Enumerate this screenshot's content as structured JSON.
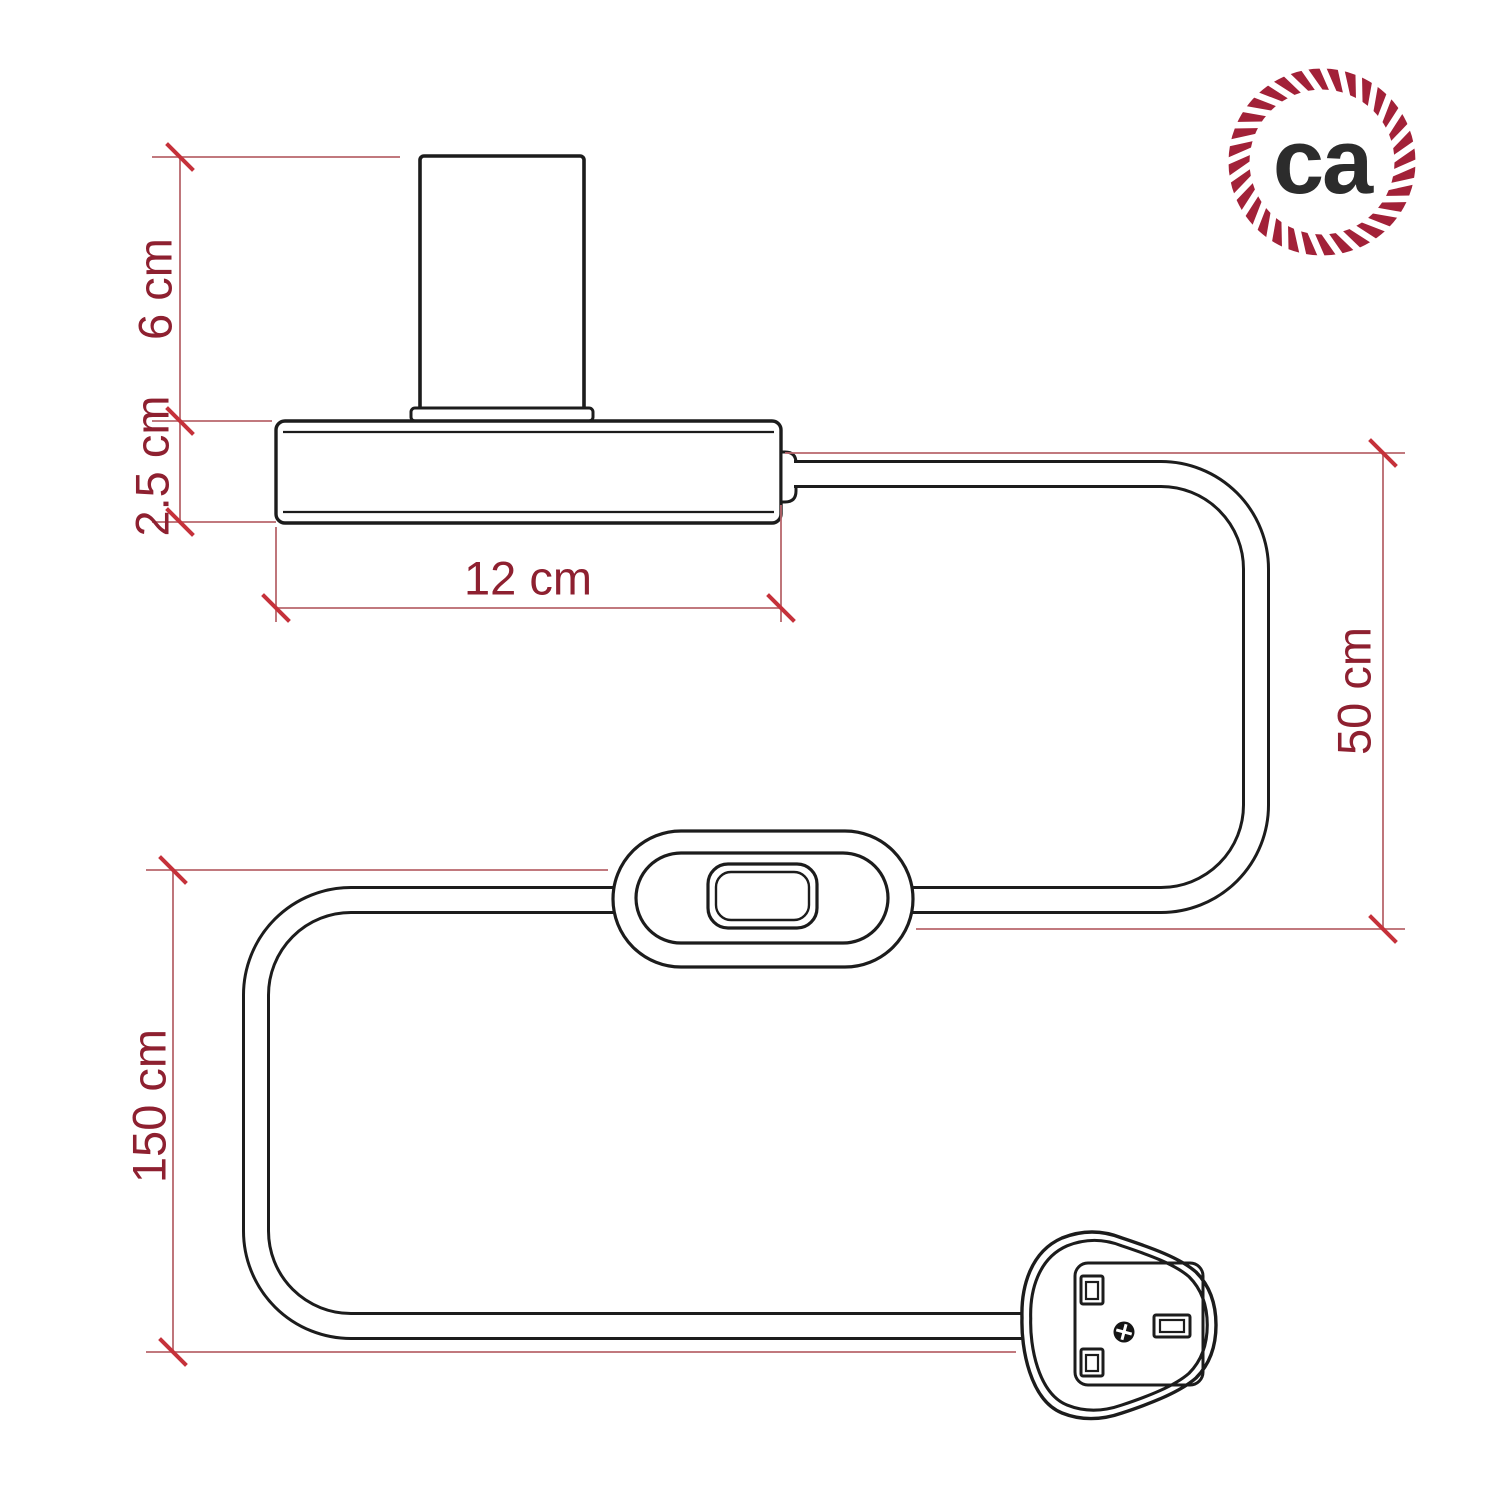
{
  "drawing": {
    "type": "technical-dimension-drawing",
    "product": "lamp holder with cable, inline switch and plug"
  },
  "dimensions": {
    "socket_height": {
      "label": "6 cm"
    },
    "base_height": {
      "label": "2.5 cm"
    },
    "base_width": {
      "label": "12 cm"
    },
    "cable_lamp_to_switch": {
      "label": "50 cm"
    },
    "cable_switch_to_plug": {
      "label": "150 cm"
    }
  },
  "logo": {
    "text": "ca"
  },
  "colors": {
    "background": "#ffffff",
    "outline": "#1c1c1c",
    "dimension_line": "#b8666c",
    "tick": "#c5313a",
    "dimension_text": "#8e2030",
    "logo_ring": "#a22138",
    "logo_text": "#2c2c2c"
  }
}
